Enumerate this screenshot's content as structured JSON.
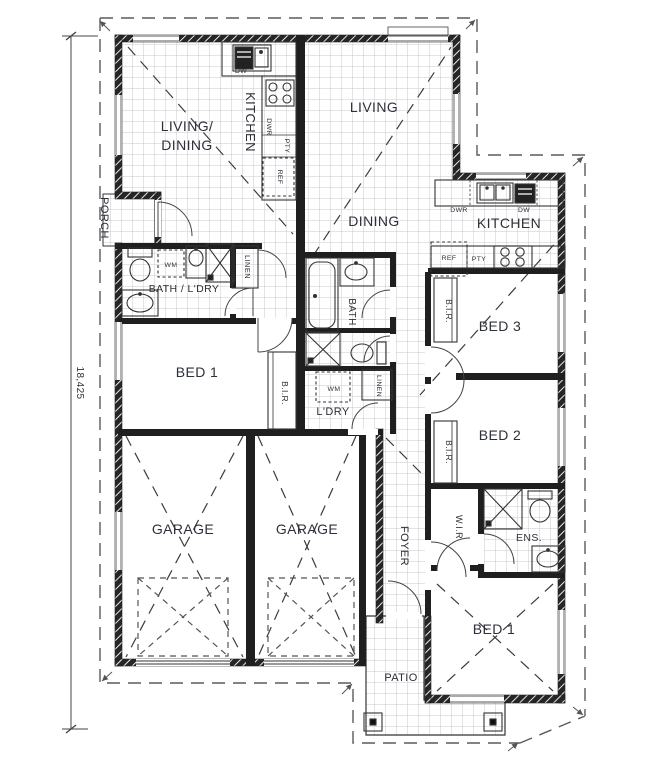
{
  "dimension": {
    "value": "18,425"
  },
  "unit1": {
    "living_line1": "LIVING/",
    "living_line2": "DINING",
    "kitchen": "KITCHEN",
    "dishwasher": "DW",
    "drawers": "DWR",
    "pantry": "PTY",
    "fridge": "REF",
    "porch": "PORCH",
    "washing_machine": "WM",
    "bath_laundry": "BATH / L'DRY",
    "linen": "LINEN",
    "bed1": "BED 1",
    "robe": "B.I.R.",
    "garage": "GARAGE"
  },
  "unit2": {
    "living": "LIVING",
    "dining": "DINING",
    "kitchen": "KITCHEN",
    "drawers": "DWR",
    "dishwasher": "DW",
    "fridge": "REF",
    "pantry": "PTY",
    "bath": "BATH",
    "linen": "LINEN",
    "washing_machine": "WM",
    "laundry": "L'DRY",
    "bed3": "BED 3",
    "bed3_robe": "B.I.R.",
    "bed2": "BED 2",
    "bed2_robe": "B.I.R.",
    "foyer": "FOYER",
    "walk_in_robe": "W.I.R",
    "ensuite": "ENS.",
    "bed1": "BED 1",
    "patio": "PATIO",
    "garage": "GARAGE"
  },
  "colors": {
    "wall": "#1f1f1f",
    "tile_line": "#c8c8cc",
    "label": "#2c3038",
    "boundary": "#5a5a5a"
  }
}
